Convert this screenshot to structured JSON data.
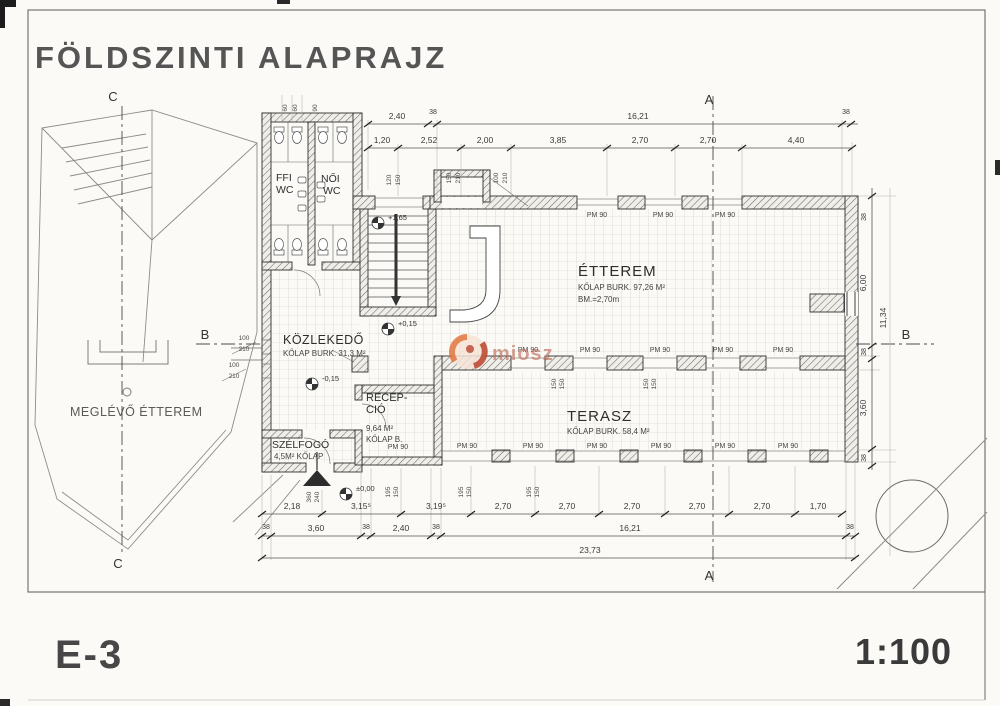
{
  "sheet": {
    "title": "FÖLDSZINTI ALAPRAJZ",
    "number": "E-3",
    "scale": "1:100"
  },
  "watermark": {
    "text": "miosz",
    "logo_color_1": "#e2753f",
    "logo_color_2": "#b8442c"
  },
  "rooms": {
    "etterem": {
      "name": "ÉTTEREM",
      "area": "KŐLAP BURK. 97,26 M²",
      "height": "BM.=2,70m"
    },
    "terasz": {
      "name": "TERASZ",
      "area": "KŐLAP BURK. 58,4 M²"
    },
    "kozlekedo": {
      "name": "KÖZLEKEDŐ",
      "area": "KŐLAP BURK. 31,3 M²"
    },
    "recepcio": {
      "name1": "RECEP-",
      "name2": "CIÓ",
      "area": "9,64 M²",
      "finish": "KŐLAP B."
    },
    "szelfogo": {
      "name": "SZÉLFOGÓ",
      "area": "4,5M² KŐLAP"
    },
    "ffi_wc": {
      "line1": "FFI",
      "line2": "WC"
    },
    "noi_wc": {
      "line1": "NŐI",
      "line2": "WC"
    },
    "existing": {
      "name": "MEGLÉVŐ ÉTTEREM"
    }
  },
  "levels": {
    "zero": "±0,00",
    "up015": "+0,15",
    "down015": "-0,15",
    "up165": "+1,65"
  },
  "sections": {
    "a": "A",
    "b": "B",
    "c": "C"
  },
  "window_label": "PM 90",
  "dims": {
    "top1": [
      "2,40",
      "38",
      "16,21",
      "38"
    ],
    "top2": [
      "1,20",
      "2,52",
      "2,00",
      "3,85",
      "2,70",
      "2,70",
      "4,40"
    ],
    "bottom1": [
      "2,18",
      "3,15⁵",
      "3,19⁵",
      "2,70",
      "2,70",
      "2,70",
      "2,70",
      "2,70",
      "1,70"
    ],
    "bottom2": [
      "38",
      "3,60",
      "38",
      "2,40",
      "38",
      "16,21",
      "38"
    ],
    "total": "23,73",
    "right": [
      "38",
      "6,00",
      "38",
      "3,60",
      "38"
    ],
    "right_total": "11,34",
    "pairs": {
      "p120_150": {
        "a": "120",
        "b": "150"
      },
      "p150_210": {
        "a": "150",
        "b": "210"
      },
      "p100_210": {
        "a": "100",
        "b": "210"
      },
      "p195_150": {
        "a": "195",
        "b": "150"
      },
      "p150_150": {
        "a": "150",
        "b": "150"
      },
      "entry": {
        "a": "360",
        "b": "240"
      }
    },
    "small60": "60",
    "small90": "90"
  }
}
